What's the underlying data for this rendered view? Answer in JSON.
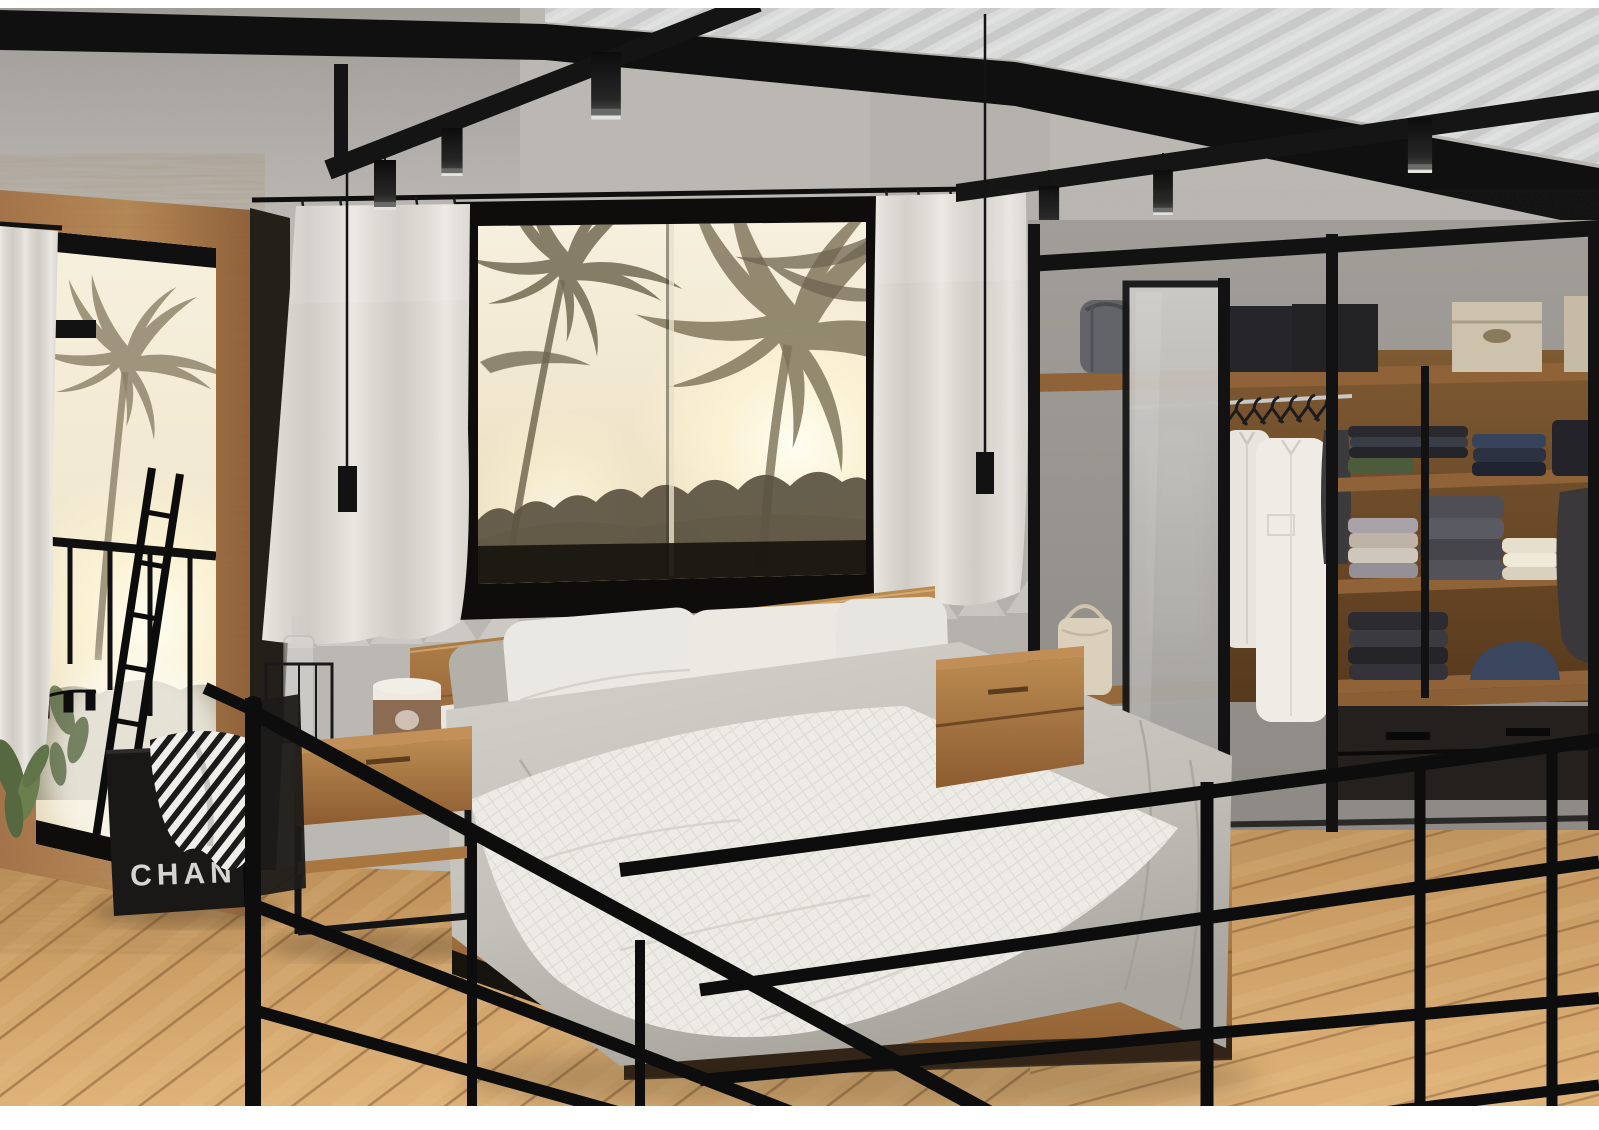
{
  "scene": {
    "type": "3D interior render",
    "room": "industrial loft bedroom on a mezzanine",
    "description": "Black steel framed loft bedroom: platform bed with gray and white bedding, sepia palm-tree window view, wood framed mirror, white curtains, open walk-in wardrobe with frosted sliding door, oak plank floor and black metal railing",
    "window_view": "sepia palm trees, sun haze and tropical foliage",
    "bag": {
      "item": "black designer shopping bag with striped scarf",
      "label_visible": "CHAN"
    },
    "lighting": [
      "cylinder track pendants on black beams",
      "two long cable pendant lamps"
    ],
    "objects": [
      "corrugated metal roof",
      "black ceiling beams",
      "track pendant lights",
      "wood framed mirror with palm reflection",
      "white side curtain",
      "green plant leaves",
      "picture window with palm view",
      "white curtain panels on black rod",
      "platform bed",
      "wood headboard",
      "white pillows",
      "gray pillows",
      "gray duvet",
      "white quilted throw",
      "wood nightstand left",
      "wood nightstand right",
      "glass bottle in wire lantern",
      "candle cup",
      "walk-in wardrobe",
      "frosted glass sliding door",
      "hanging white shirts",
      "gray duffel bag",
      "black storage boxes",
      "beige storage boxes",
      "cream tote bag",
      "folded clothes stacks",
      "wardrobe drawers",
      "black shopping bag",
      "striped scarf",
      "black metal railing",
      "oak plank floor"
    ]
  },
  "palette": {
    "wall_concrete": "#bcb9b4",
    "wall_dark": "#98948f",
    "beam_black": "#121212",
    "roof_white": "#eef0ef",
    "sepia_sky": "#f2ead6",
    "palm_silhouette": "#7a7158",
    "curtain_white": "#e6e3dd",
    "wood_warm": "#ad7a45",
    "wood_shelf": "#8f6237",
    "floor_oak": "#cfa065",
    "duvet_gray": "#c7c4bd",
    "linen_white": "#edebe5",
    "frost_glass": "#b9b7b3",
    "clothes_navy": "#3a4558",
    "box_beige": "#cdc3ad",
    "bag_black": "#191817",
    "bag_label_text": "#d6d4d0"
  }
}
